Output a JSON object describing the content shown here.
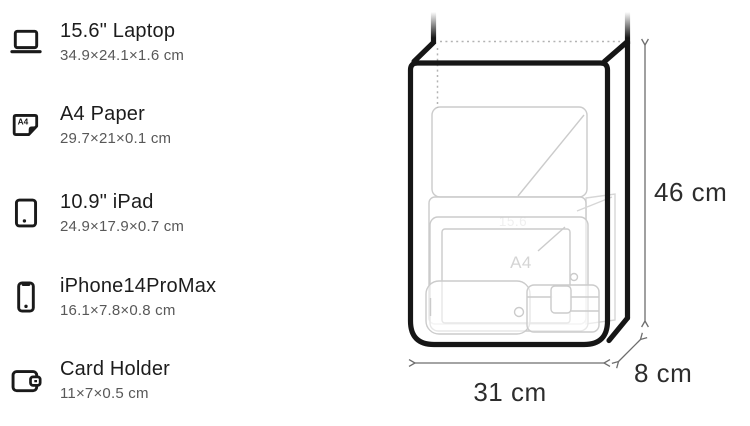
{
  "items": [
    {
      "name": "15.6\" Laptop",
      "dims": "34.9×24.1×1.6 cm",
      "icon": "laptop-icon"
    },
    {
      "name": "A4 Paper",
      "dims": "29.7×21×0.1 cm",
      "icon": "a4-paper-icon"
    },
    {
      "name": "10.9\" iPad",
      "dims": "24.9×17.9×0.7 cm",
      "icon": "ipad-icon"
    },
    {
      "name": "iPhone14ProMax",
      "dims": "16.1×7.8×0.8 cm",
      "icon": "iphone-icon"
    },
    {
      "name": "Card Holder",
      "dims": "11×7×0.5 cm",
      "icon": "wallet-icon"
    }
  ],
  "icons": {
    "a4_text": "A4"
  },
  "diagram": {
    "height_label": "46 cm",
    "width_label": "31 cm",
    "depth_label": "8 cm",
    "inner_laptop_label": "15.6",
    "inner_a4_label": "A4"
  },
  "colors": {
    "outline_black": "#161616",
    "faint_item_gray": "#cbcbcb",
    "dimension_text": "#2d2d2d",
    "secondary_text": "#585858",
    "arrow_gray": "#6d6d6d"
  }
}
